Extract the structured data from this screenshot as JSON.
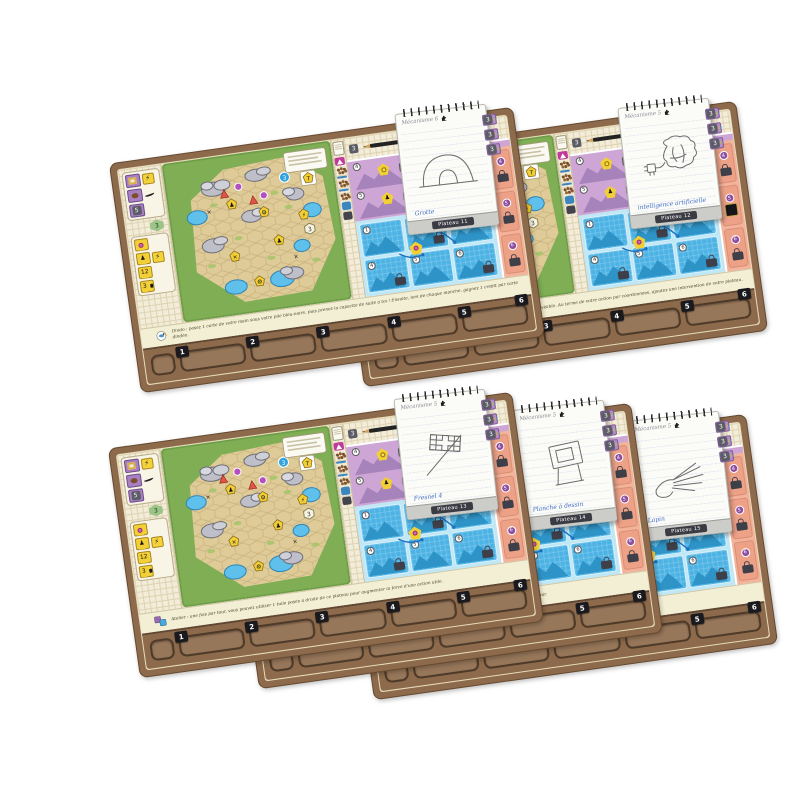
{
  "page": {
    "background": "#ffffff"
  },
  "game": {
    "board_common": {
      "left_column": {
        "purple_value": "5",
        "hex_value": "3",
        "track_values": [
          "12",
          "3"
        ],
        "lightning_icon": "lightning-icon",
        "meeple_icon": "meeple-icon",
        "puzzle_icon": "puzzle-icon"
      },
      "map": {
        "card_value": "7",
        "blue_token_value": "3",
        "hex_token_value": "3",
        "badge_icons": [
          "meeple-icon",
          "gear-icon",
          "x-mark-icon",
          "lightning-icon"
        ]
      },
      "panel": {
        "gray_tile_value": "3",
        "purple_cells": [
          {
            "num": "4",
            "badge": "3"
          },
          {
            "num": "5",
            "badge": "3"
          }
        ],
        "blue_numbers": [
          "1",
          "2",
          "3",
          "4",
          "5",
          "6"
        ],
        "orange_numbers": [
          "4",
          "5",
          "6"
        ],
        "token_value": "3"
      },
      "tabs": [
        "1",
        "2",
        "3",
        "4",
        "5",
        "6"
      ]
    },
    "boards": [
      {
        "notepad": {
          "title": "Mécanisme 6",
          "sketch": "cave",
          "label": "Grotte",
          "footer": "Plateau 11"
        },
        "bottom": {
          "icon": "bird",
          "text": "Dindo : posez 1 carte de votre main sous votre pile bleu-noire, puis prenez la capacité de suite à toi ! Ensuite, lors de chaque manche, gagnez 1 crédit par carte dindée."
        }
      },
      {
        "notepad": {
          "title": "Mécanisme 5",
          "sketch": "brain",
          "label": "intelligence artificielle",
          "footer": "Plateau 12"
        },
        "panel_variant": "chip",
        "bottom": {
          "icon": "chip",
          "text": "Durant la fin d'action la plus à gauche, visitez 1/2 de votre registre visible. Au terme de votre action par coordonnées, ajoutez une intervention de votre plateau."
        }
      },
      {
        "notepad": {
          "title": "Mécanisme 5",
          "sketch": "flag",
          "label": "Fresnel 4",
          "footer": "Plateau 13"
        },
        "bottom": {
          "icon": "tiles",
          "text": "Atelier : une fois par tour, vous pouvez utiliser 1 tuile posée à droite de ce plateau pour augmenter la force d'une action utile."
        }
      },
      {
        "notepad": {
          "title": "Mécanisme 5",
          "sketch": "drafting",
          "label": "Planche à dessin",
          "footer": "Plateau 14"
        },
        "bottom": {
          "icon": "xmark",
          "text": "1 seule ressource simplifiée sur une case de votre plateau : gagnez le bonus associé. Engagez en face le temps à venir."
        }
      },
      {
        "notepad": {
          "title": "Mécanisme 5",
          "sketch": "hand",
          "label": "Lapin",
          "footer": "Plateau 15"
        },
        "bottom": {
          "icon": "magnifier",
          "text": "Piochez des cartes jusqu'à trouver une carte réalisée et agissez. L'esprit s'applique également au-delà de la partie."
        }
      }
    ]
  }
}
